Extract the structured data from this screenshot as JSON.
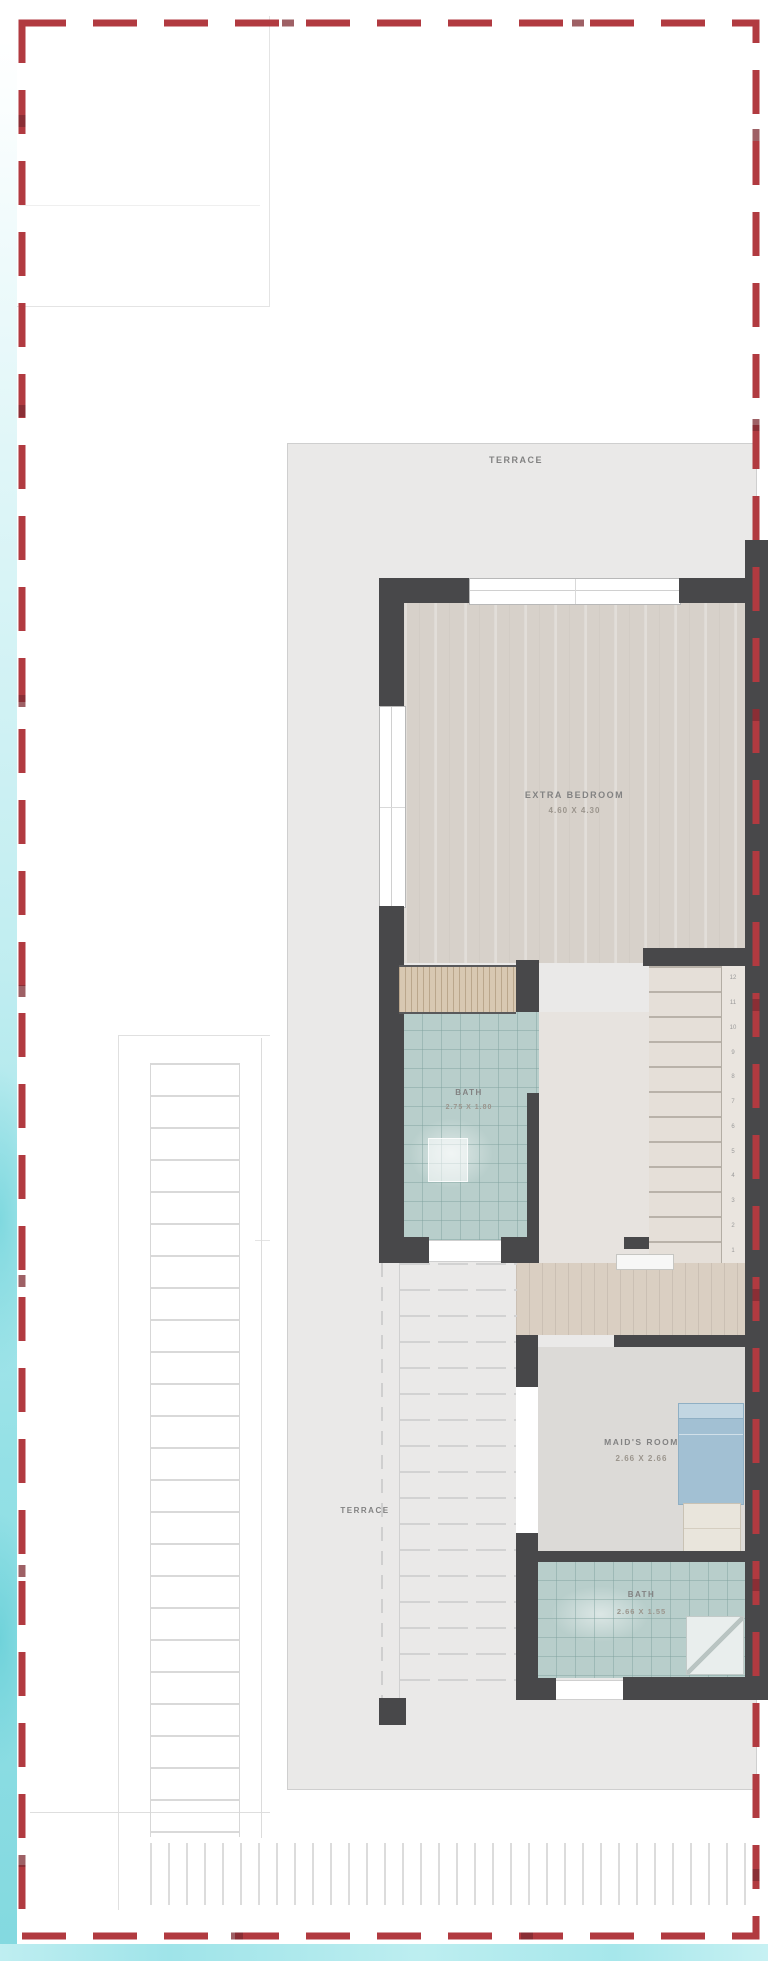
{
  "plan": {
    "rooms": {
      "terrace_top": {
        "label": "TERRACE"
      },
      "extra_bedroom": {
        "label": "EXTRA BEDROOM",
        "dims": "4.60 X 4.30"
      },
      "bath1": {
        "label": "BATH",
        "dims": "2.75 X 1.80"
      },
      "maids_room": {
        "label": "MAID'S ROOM",
        "dims": "2.66 X 2.66"
      },
      "terrace_side": {
        "label": "TERRACE"
      },
      "bath2": {
        "label": "BATH",
        "dims": "2.66 X 1.55"
      }
    },
    "stair_numbers": [
      "12",
      "11",
      "10",
      "9",
      "8",
      "7",
      "6",
      "5",
      "4",
      "3",
      "2",
      "1"
    ],
    "colors": {
      "boundary_red": "#b13a40",
      "wall_charcoal": "#48484a",
      "bath_tile_teal": "#b8cecb",
      "bed_blue": "#a2c0d3",
      "bedroom_floor": "#d7d1ca",
      "terrace_gray": "#eae9e8",
      "watercolor_cyan": "#8edee3"
    }
  }
}
